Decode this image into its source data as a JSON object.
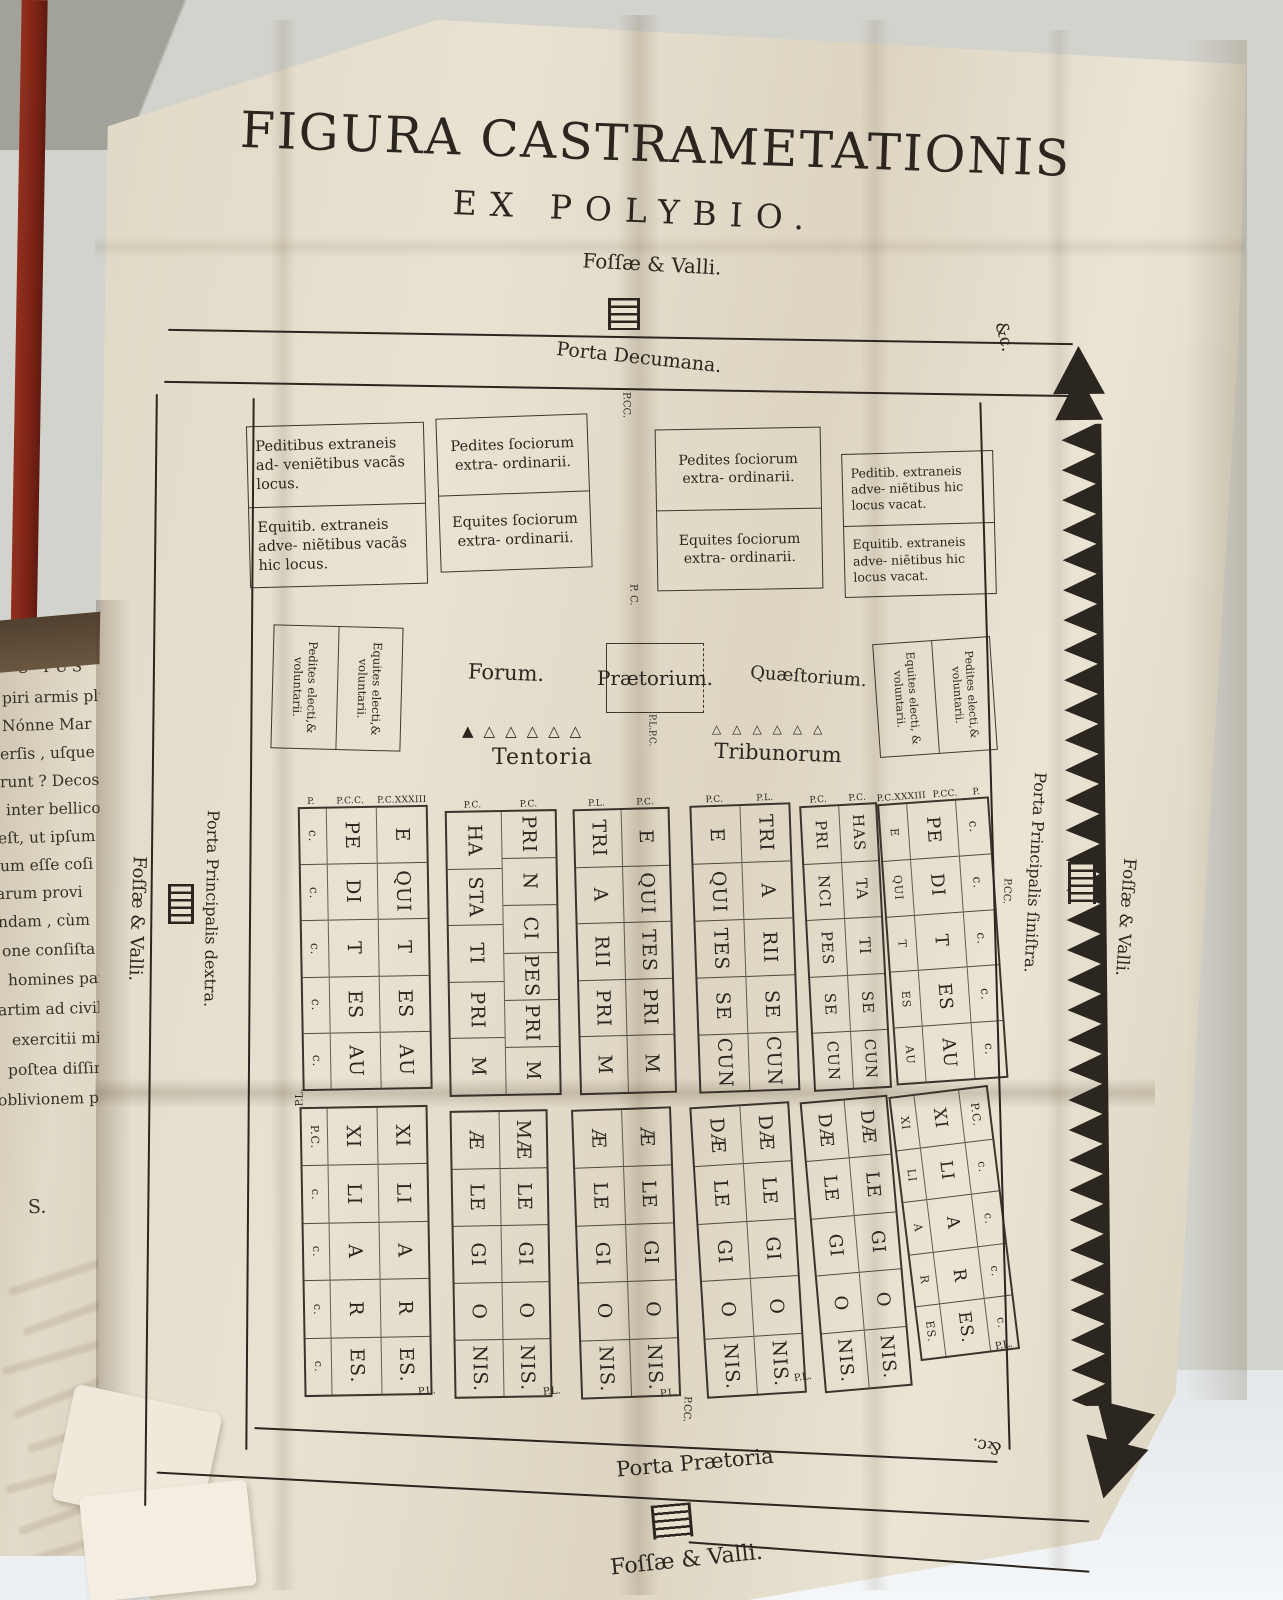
{
  "title": {
    "line1": "FIGURA CASTRAMETATIONIS",
    "line2": "EX POLYBIO."
  },
  "labels": {
    "fossae_top": "Foſſæ & Valli.",
    "porta_decumana": "Porta Decumana.",
    "p_cc_top": "P.CC.",
    "p_c_mid": "P. C.",
    "forum": "Forum.",
    "praetorium": "Prætorium.",
    "quaestorium": "Quæſtorium.",
    "p_l_p_c": "P.L.P.C.",
    "tentoria": "Tentoria",
    "tribunorum": "Tribunorum",
    "porta_praetoria": "Porta Prætoria",
    "p_cc_bottom": "P.CC.",
    "fossae_bottom": "Foſſæ & Valli.",
    "fossae_left": "Foſſæ & Valli.",
    "porta_dextra": "Porta Principalis dextra.",
    "p_cc_right": "P.CC.",
    "porta_sinistra": "Porta Principalis ſiniſtra.",
    "fossae_right": "Foſſæ & Valli.",
    "etc_top": "&c.",
    "etc_bottom": "&c."
  },
  "outer_boxes": [
    {
      "top": "Peditibus extraneis ad- veniẽtibus vacãs locus.",
      "bottom": "Equitib. extraneis adve- niẽtibus vacãs hic locus."
    },
    {
      "top": "Pedites ſociorum extra- ordinarii.",
      "bottom": "Equites ſociorum extra- ordinarii."
    },
    {
      "top": "Pedites ſociorum extra- ordinarii.",
      "bottom": "Equites ſociorum extra- ordinarii."
    },
    {
      "top": "Peditib. extraneis adve- niẽtibus hic locus vacat.",
      "bottom": "Equitib. extraneis adve- niẽtibus hic locus vacat."
    }
  ],
  "electi_left": [
    "Pedites electi,& voluntarii.",
    "Equites electi,& voluntarii."
  ],
  "electi_right": [
    "Equites electi, & voluntarii.",
    "Pedites electi,& voluntarii."
  ],
  "tentoria_triangles": 6,
  "tribunorum_triangles": 6,
  "grid_top": [
    {
      "headers": [
        "P.",
        "P.C.C.",
        "P.C.XXXIII"
      ],
      "columns": [
        [
          "c.",
          "c.",
          "c.",
          "c.",
          "c."
        ],
        [
          "PE",
          "DI",
          "T",
          "ES",
          "AU"
        ],
        [
          "E",
          "QUI",
          "T",
          "ES",
          "AU"
        ]
      ]
    },
    {
      "headers": [
        "P.C.",
        "P.C."
      ],
      "columns": [
        [
          "HA",
          "STA",
          "TI",
          "PRI",
          "M"
        ],
        [
          "PRI",
          "N",
          "CI",
          "PES",
          "PRI",
          "M"
        ]
      ]
    },
    {
      "headers": [
        "P.L.",
        "P.C."
      ],
      "columns": [
        [
          "TRI",
          "A",
          "RII",
          "PRI",
          "M"
        ],
        [
          "E",
          "QUI",
          "TES",
          "PRI",
          "M"
        ]
      ]
    },
    {
      "headers": [
        "P.C.",
        "P.L."
      ],
      "columns": [
        [
          "E",
          "QUI",
          "TES",
          "SE",
          "CUN"
        ],
        [
          "TRI",
          "A",
          "RII",
          "SE",
          "CUN"
        ]
      ]
    },
    {
      "headers": [
        "P.C.",
        "P.C."
      ],
      "columns": [
        [
          "PRI",
          "NCI",
          "PES",
          "SE",
          "CUN"
        ],
        [
          "HAS",
          "TA",
          "TI",
          "SE",
          "CUN"
        ]
      ]
    },
    {
      "headers": [
        "P.C.XXXIII",
        "P.CC.",
        "P."
      ],
      "columns": [
        [
          "E",
          "QUI",
          "T",
          "ES",
          "AU"
        ],
        [
          "PE",
          "DI",
          "T",
          "ES",
          "AU"
        ],
        [
          "c.",
          "c.",
          "c.",
          "c.",
          "c."
        ]
      ]
    }
  ],
  "grid_bottom": [
    {
      "columns": [
        [
          "P.C.",
          "c.",
          "c.",
          "c.",
          "c."
        ],
        [
          "XI",
          "LI",
          "A",
          "R",
          "ES."
        ],
        [
          "XI",
          "LI",
          "A",
          "R",
          "ES."
        ]
      ]
    },
    {
      "columns": [
        [
          "Æ",
          "LE",
          "GI",
          "O",
          "NIS."
        ],
        [
          "MÆ",
          "LE",
          "GI",
          "O",
          "NIS."
        ]
      ]
    },
    {
      "columns": [
        [
          "Æ",
          "LE",
          "GI",
          "O",
          "NIS."
        ],
        [
          "Æ",
          "LE",
          "GI",
          "O",
          "NIS."
        ]
      ]
    },
    {
      "columns": [
        [
          "DÆ",
          "LE",
          "GI",
          "O",
          "NIS."
        ],
        [
          "DÆ",
          "LE",
          "GI",
          "O",
          "NIS."
        ]
      ]
    },
    {
      "columns": [
        [
          "DÆ",
          "LE",
          "GI",
          "O",
          "NIS."
        ],
        [
          "DÆ",
          "LE",
          "GI",
          "O",
          "NIS."
        ]
      ]
    },
    {
      "columns": [
        [
          "XI",
          "LI",
          "A",
          "R",
          "ES."
        ],
        [
          "XI",
          "LI",
          "A",
          "R",
          "ES."
        ],
        [
          "P.C.",
          "c.",
          "c.",
          "c.",
          "c."
        ]
      ]
    }
  ],
  "street_marks": [
    "P.L.",
    "P.L.",
    "P.L.",
    "P.L.",
    "P.L.",
    "P.L."
  ],
  "page_fragments": [
    "S TUS",
    "piri armis plu",
    "Nónne Mar",
    "erſis , uſque a",
    "runt ? Decos",
    "inter bellicoſ",
    "eſt, ut ipſum M",
    "um eſſe coſi",
    "arum provi",
    "ndam , cùm",
    "one conſiſta",
    "homines parti",
    "artim ad civil",
    "exercitii mil",
    "poſtea diſſim",
    "oblivionem pe",
    "S."
  ],
  "colors": {
    "ink": "#2b261f",
    "paper": "#e6dfcd",
    "spine_red": "#7c2315"
  }
}
